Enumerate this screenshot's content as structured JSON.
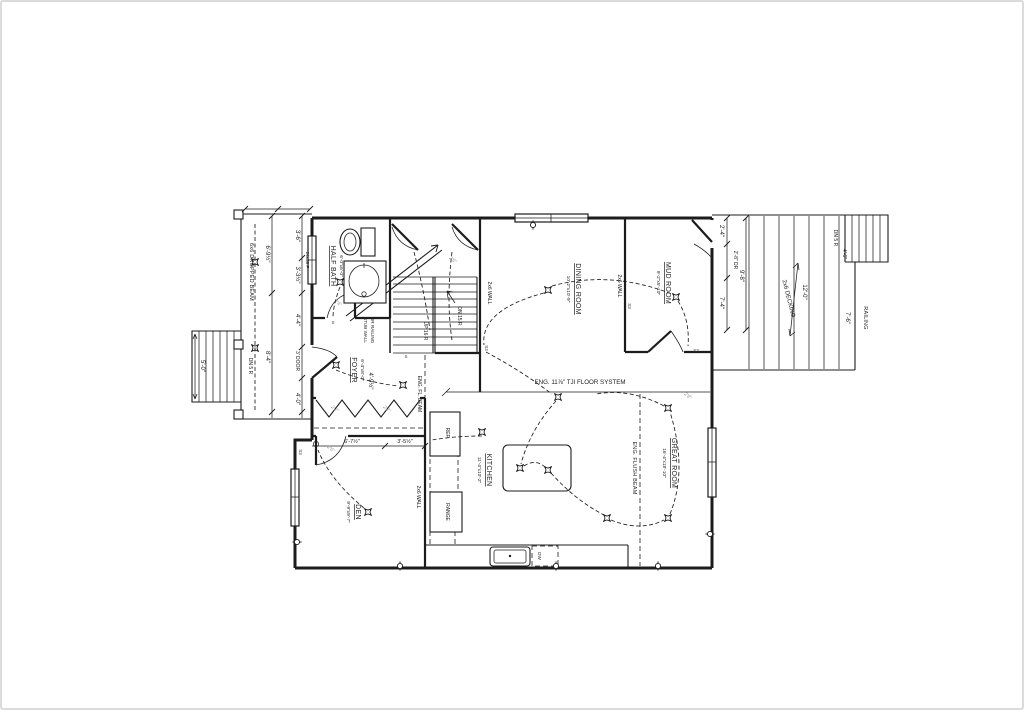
{
  "colors": {
    "line": "#1c1c1c",
    "muted": "#9a9a9a",
    "background": "#ffffff",
    "border": "#cfcfcf"
  },
  "rooms": {
    "half_bath": {
      "name": "HALF BATH",
      "dims": "6'-0\"x6'-0\""
    },
    "foyer": {
      "name": "FOYER",
      "dims": "6'-4\"x8'-0\""
    },
    "dining": {
      "name": "DINING ROOM",
      "dims": "10'-2\"x10'-9\""
    },
    "mud": {
      "name": "MUD ROOM",
      "dims": "9'-2\"x5'-10\""
    },
    "kitchen": {
      "name": "KITCHEN",
      "dims": "11'-4\"x10'-2\""
    },
    "great": {
      "name": "GREAT ROOM",
      "dims": "16'-4\"x18'-10\""
    },
    "den": {
      "name": "DEN",
      "dims": "9'-9\"x9'-7\""
    }
  },
  "stairs": {
    "up": "UP 16 R",
    "down": "DN 15 R",
    "stub_line1": "STUB WALL",
    "stub_line2": "OR RAILING",
    "porch_down": "DN 5 R",
    "porch_stair_width": "5'-0\"",
    "deck_down": "DN 5 R",
    "deck_stair_width": "4'-6\""
  },
  "structure": {
    "dropped_beam": "6x6 DROPPED BEAM",
    "tji_floor": "ENG. 11⅞\" TJI FLOOR SYSTEM",
    "flush_beam": "ENG. FLUSH BEAM",
    "floor_beam": "ENG. FL. BEAM",
    "wall_dining_w": "2x6 WALL",
    "wall_dining_e": "2x6 WALL",
    "wall_kitchen_w": "2x6 WALL",
    "decking": "2x6 DECKING",
    "railing": "RAILING",
    "window_tag": "24x36 P",
    "front_door_tag": "3' DOOR"
  },
  "appliances": {
    "fridge": "REF.",
    "range": "RANGE",
    "dishwasher": "DW"
  },
  "dimensions": {
    "porch_a1": "6'-9½\"",
    "porch_a2": "8'-4\"",
    "porch_b1": "3'-6\"",
    "porch_b2": "3'-3½\"",
    "porch_b3": "4'-4\"",
    "porch_b4": "4'-0\"",
    "hall_w1": "6'-7½\"",
    "hall_w2": "3'-5½\"",
    "foyer_w": "4'-9½\"",
    "right_1": "2'-4\"",
    "right_door": "2'-8\" DR",
    "right_2": "7'-4\"",
    "right_total": "9'-8\"",
    "deck_depth": "12'-0\"",
    "deck_lower": "7'-6\""
  },
  "door_tags": {
    "closet_l": "2'2\"",
    "closet_r": "2'2\"",
    "den": "2'6\"",
    "mud": "2'8\"",
    "bath": "2'4\"",
    "stair": "2'6\""
  },
  "switches": {
    "a": "S3",
    "b": "S3",
    "c": "S3",
    "d": "S",
    "e": "S3",
    "f": "S"
  }
}
